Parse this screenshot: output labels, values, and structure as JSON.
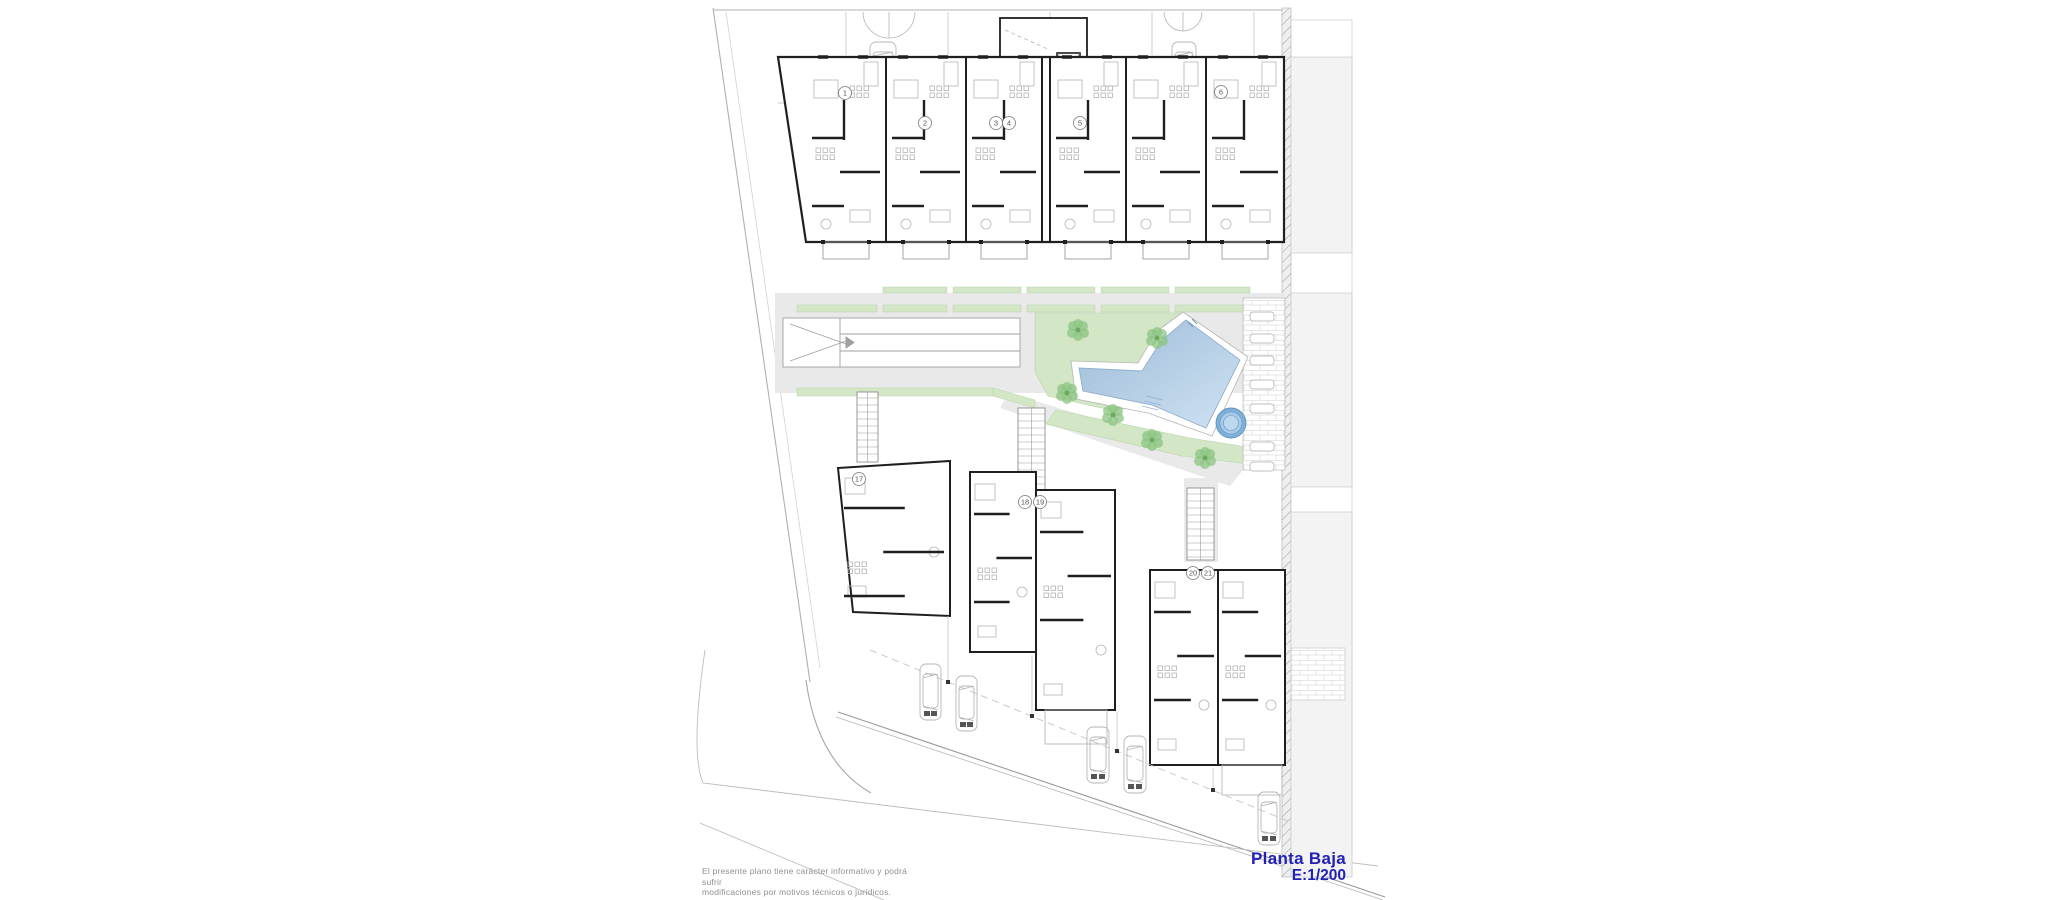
{
  "drawing": {
    "title_line1": "Planta Baja",
    "title_line2": "E:1/200",
    "disclaimer_line1": "El presente plano tiene carácter informativo y podrá sufrir",
    "disclaimer_line2": "modificaciones por motivos técnicos o jurídicos.",
    "unit_badges": {
      "top": [
        "1",
        "2",
        "3",
        "4",
        "5",
        "6"
      ],
      "bottom": [
        "17",
        "18",
        "19",
        "20",
        "21"
      ]
    },
    "palette": {
      "accent_blue": "#2121b5",
      "wall_dark": "#1f1f1f",
      "line_gray": "#b0b0b0",
      "furniture_gray": "#b5b5b5",
      "path_gray": "#e9e9e9",
      "garden_green": "#d3e7c6",
      "palm_green": "#8cc482",
      "pool_blue": "#a9c7e2",
      "pool_blue_light": "#cfe2f2",
      "jacuzzi_blue": "#7fb0d8",
      "neighbor_gray": "#f3f3f3"
    }
  }
}
